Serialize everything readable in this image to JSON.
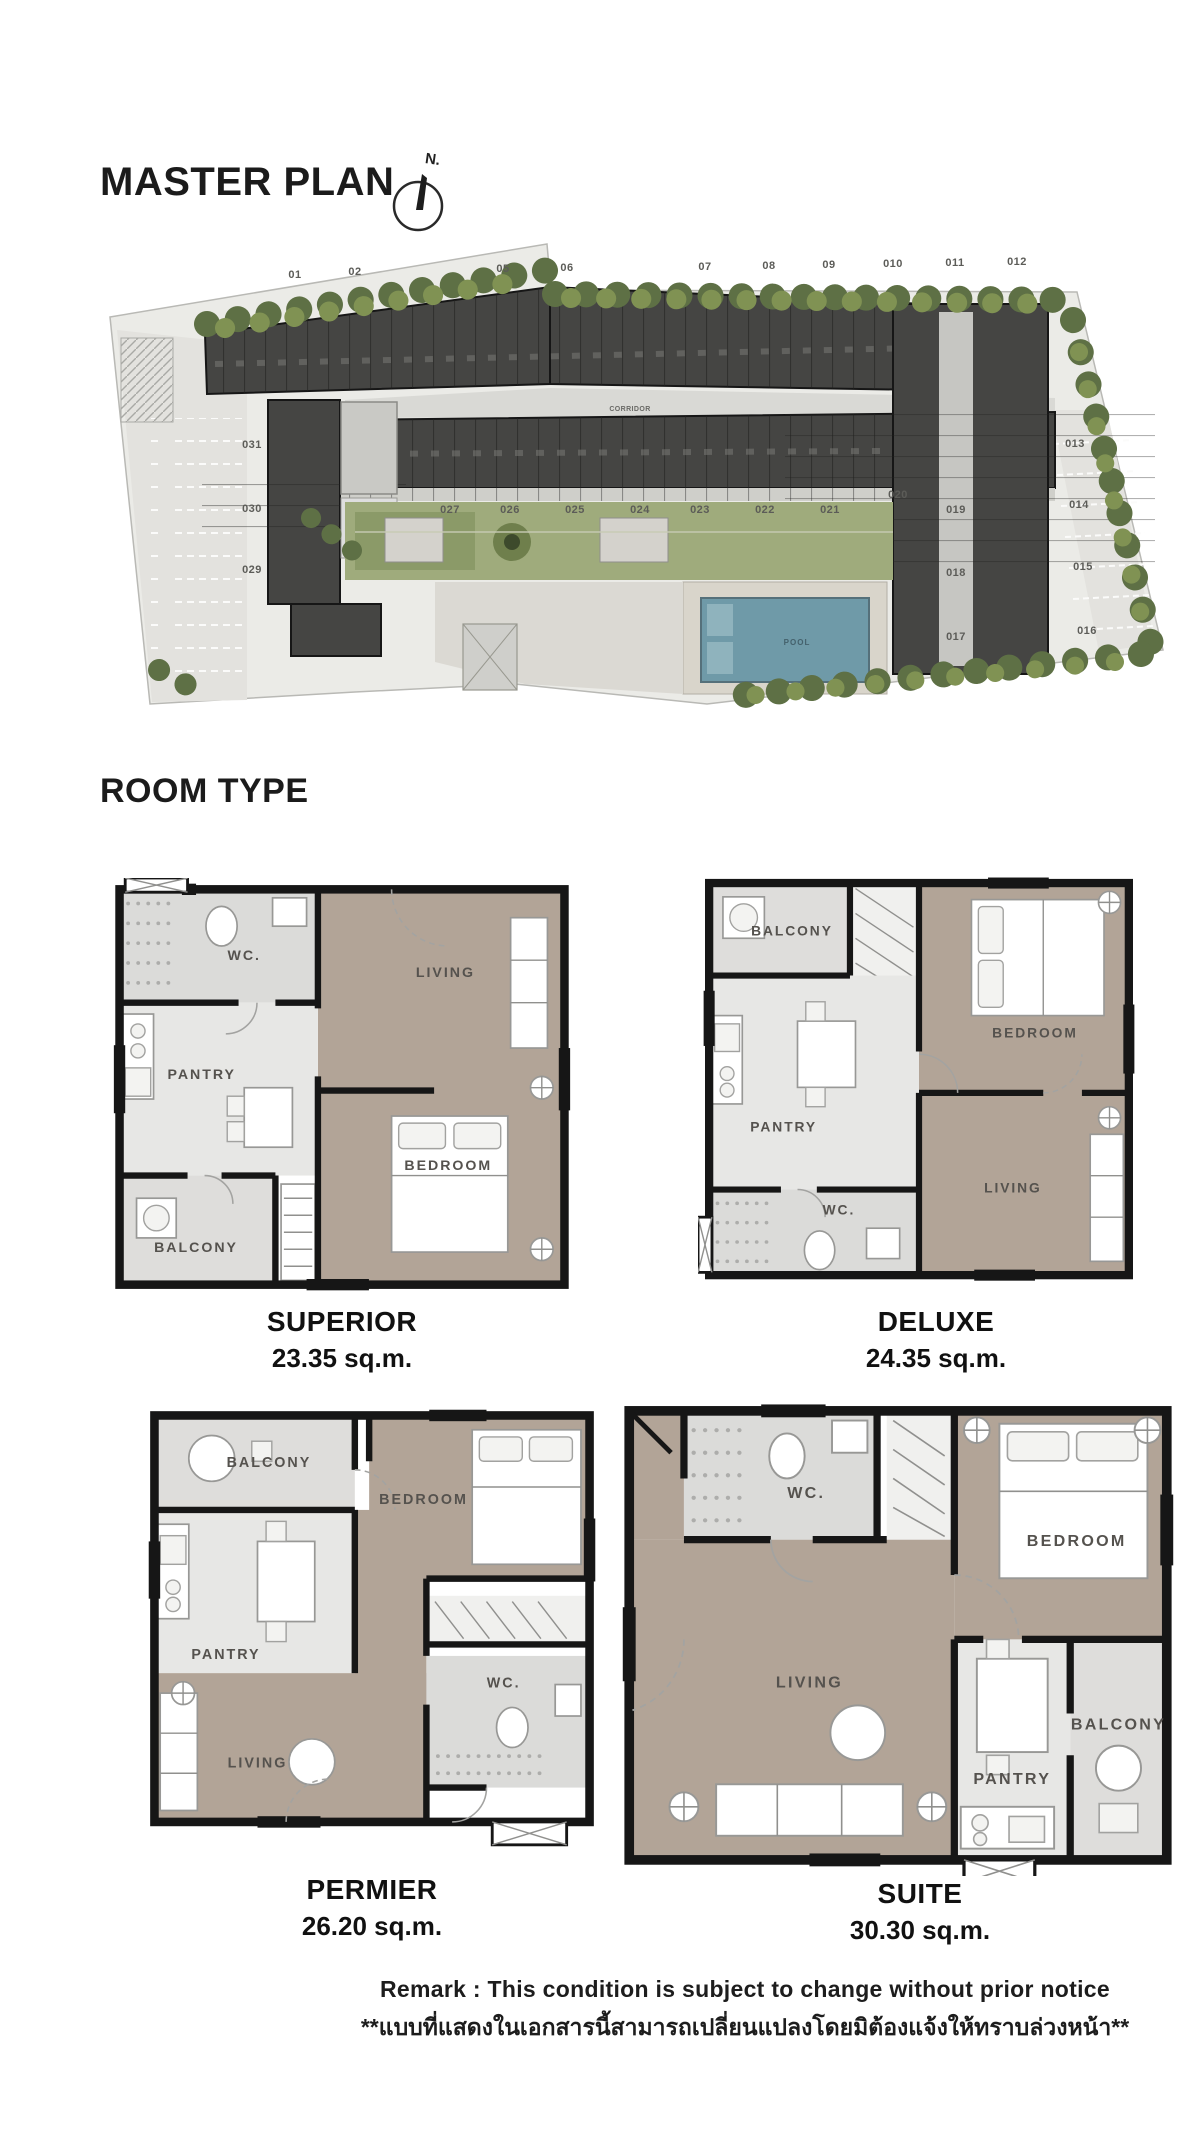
{
  "colors": {
    "ink": "#1b1b1b",
    "site": "#ebebe7",
    "parking": "#e3e2de",
    "bdark": "#454543",
    "bmid": "#8b8b87",
    "corridor": "#d9d9d5",
    "lawn": "#9fab7c",
    "lawndark": "#6f7f4c",
    "pool": "#6f9aa8",
    "pooldark": "#44616c",
    "deck": "#d9d5cb",
    "wood": "#b2a497",
    "tile": "#e7e7e5",
    "wcfloor": "#dbdbd9",
    "wall": "#161616",
    "treedark": "#5e7045",
    "treelight": "#809253"
  },
  "master_plan": {
    "title": "MASTER PLAN",
    "north_label": "N.",
    "top_units": [
      "01",
      "02",
      "05",
      "06",
      "07",
      "08",
      "09",
      "010",
      "011",
      "012"
    ],
    "left_units": [
      "031",
      "030",
      "029"
    ],
    "inner_units": [
      "027",
      "026",
      "025",
      "024",
      "023",
      "022",
      "021"
    ],
    "unit_row_end": "020",
    "right_units": [
      "013",
      "014",
      "015",
      "016"
    ],
    "right_wing_units": [
      "019",
      "018",
      "017"
    ],
    "lift_hall_label": "LIFT HALL",
    "corridor_label": "CORRIDOR",
    "pool_label": "POOL"
  },
  "room_type": {
    "title": "ROOM TYPE",
    "plans": [
      {
        "name": "SUPERIOR",
        "area": "23.35 sq.m.",
        "labels": {
          "wc": "WC.",
          "living": "LIVING",
          "pantry": "PANTRY",
          "bedroom": "BEDROOM",
          "balcony": "BALCONY"
        }
      },
      {
        "name": "DELUXE",
        "area": "24.35 sq.m.",
        "labels": {
          "balcony": "BALCONY",
          "bedroom": "BEDROOM",
          "pantry": "PANTRY",
          "wc": "WC.",
          "living": "LIVING"
        }
      },
      {
        "name": "PERMIER",
        "area": "26.20 sq.m.",
        "labels": {
          "balcony": "BALCONY",
          "bedroom": "BEDROOM",
          "pantry": "PANTRY",
          "living": "LIVING",
          "wc": "WC."
        }
      },
      {
        "name": "SUITE",
        "area": "30.30 sq.m.",
        "labels": {
          "wc": "WC.",
          "bedroom": "BEDROOM",
          "living": "LIVING",
          "pantry": "PANTRY",
          "balcony": "BALCONY"
        }
      }
    ]
  },
  "remark": {
    "line1": "Remark : This condition is subject to change without prior notice",
    "line2": "**แบบที่แสดงในเอกสารนี้สามารถเปลี่ยนแปลงโดยมิต้องแจ้งให้ทราบล่วงหน้า**"
  }
}
